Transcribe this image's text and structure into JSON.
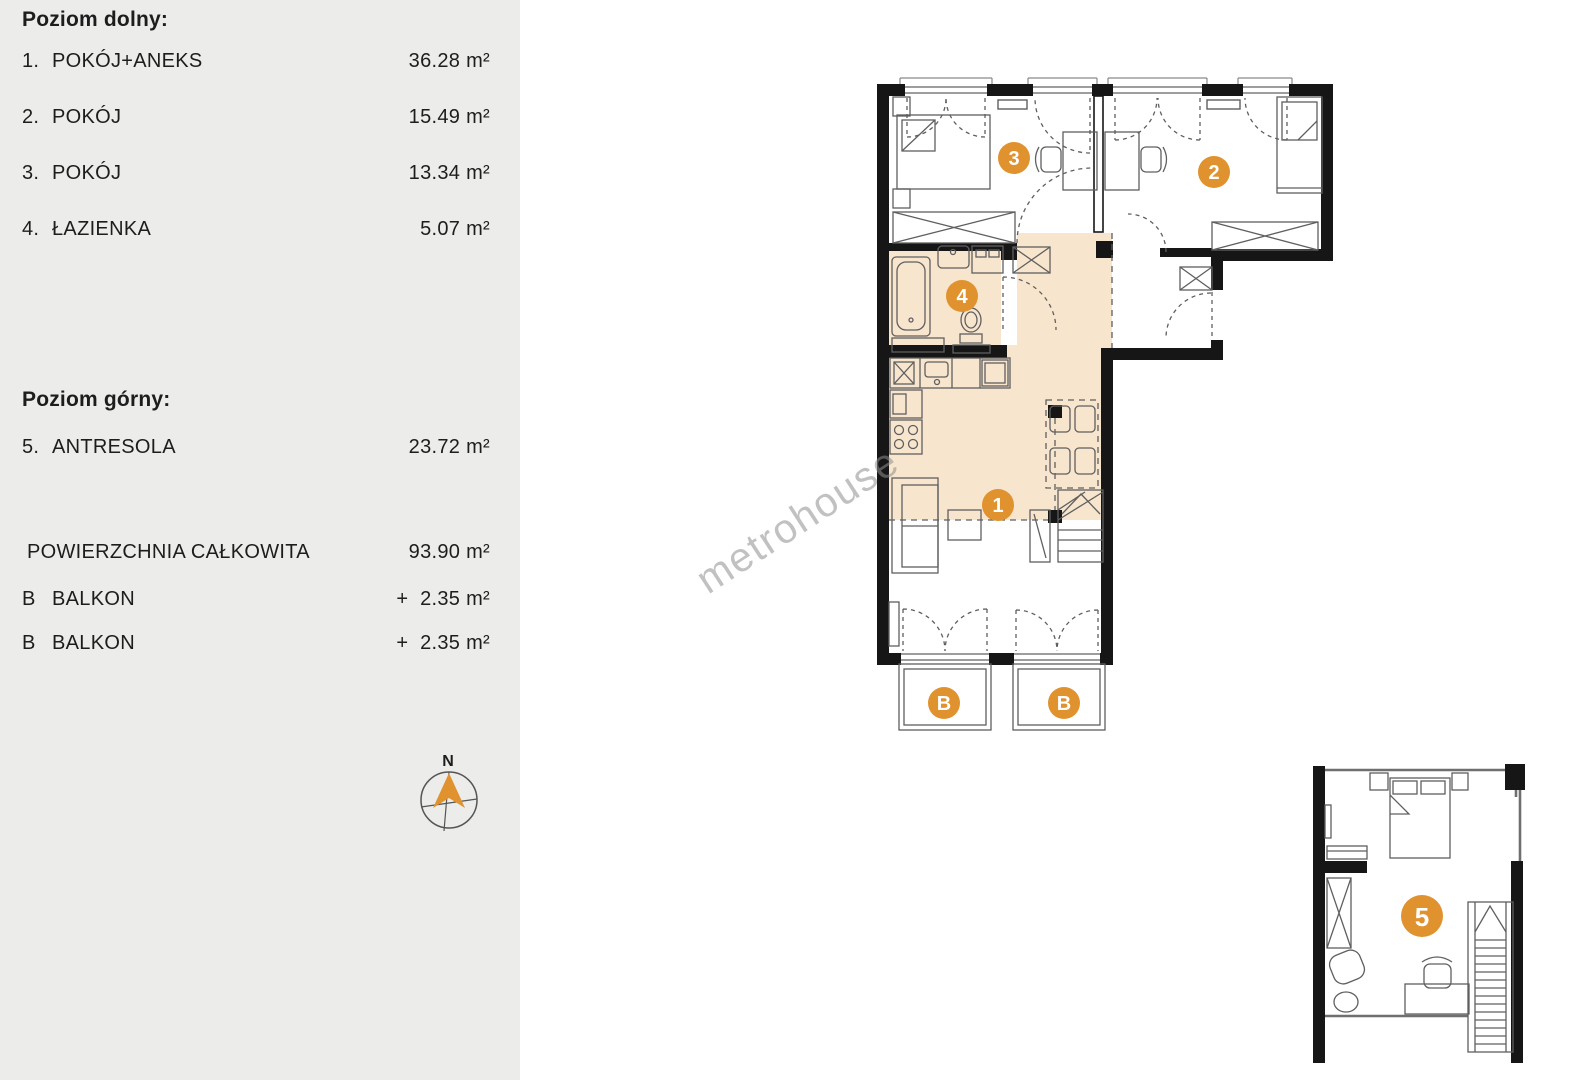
{
  "sidebar": {
    "lower_heading": "Poziom dolny:",
    "rooms_lower": [
      {
        "num": "1.",
        "name": "POKÓJ+ANEKS",
        "area": "36.28 m²"
      },
      {
        "num": "2.",
        "name": "POKÓJ",
        "area": "15.49 m²"
      },
      {
        "num": "3.",
        "name": "POKÓJ",
        "area": "13.34 m²"
      },
      {
        "num": "4.",
        "name": "ŁAZIENKA",
        "area": "5.07 m²"
      }
    ],
    "upper_heading": "Poziom górny:",
    "rooms_upper": [
      {
        "num": "5.",
        "name": "ANTRESOLA",
        "area": "23.72 m²"
      }
    ],
    "total": {
      "name": "POWIERZCHNIA CAŁKOWITA",
      "area": "93.90 m²"
    },
    "balconies": [
      {
        "num": "B",
        "name": "BALKON",
        "area": "+  2.35 m²"
      },
      {
        "num": "B",
        "name": "BALKON",
        "area": "+  2.35 m²"
      }
    ],
    "compass": {
      "label": "N"
    }
  },
  "plan": {
    "watermark": "metrohouse",
    "markers": [
      {
        "label": "1",
        "x": 998,
        "y": 505,
        "r": 16
      },
      {
        "label": "2",
        "x": 1214,
        "y": 172,
        "r": 16
      },
      {
        "label": "3",
        "x": 1014,
        "y": 158,
        "r": 16
      },
      {
        "label": "4",
        "x": 962,
        "y": 296,
        "r": 16
      },
      {
        "label": "5",
        "x": 1422,
        "y": 916,
        "r": 21
      },
      {
        "label": "B",
        "x": 944,
        "y": 703,
        "r": 16
      },
      {
        "label": "B",
        "x": 1064,
        "y": 703,
        "r": 16
      }
    ],
    "colors": {
      "accent": "#E0922E",
      "room_fill": "#F8E5CE",
      "wall": "#161616",
      "furniture": "#5f5f5f"
    }
  }
}
